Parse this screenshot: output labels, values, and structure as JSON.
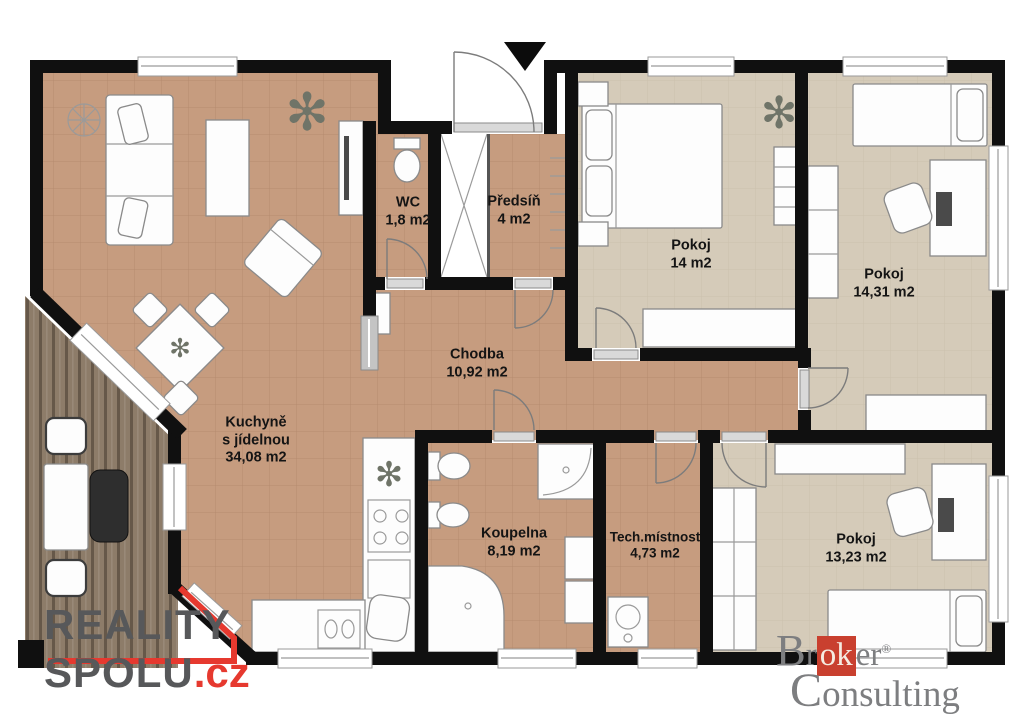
{
  "title": "Floor plan",
  "rooms": {
    "kuchyne": {
      "label": "Kuchyně",
      "label2": "s jídelnou",
      "area": "34,08 m2"
    },
    "wc": {
      "label": "WC",
      "area": "1,8 m2"
    },
    "predsin": {
      "label": "Předsíň",
      "area": "4 m2"
    },
    "chodba": {
      "label": "Chodba",
      "area": "10,92 m2"
    },
    "koupelna": {
      "label": "Koupelna",
      "area": "8,19 m2"
    },
    "tech": {
      "label": "Tech.místnost",
      "area": "4,73 m2"
    },
    "pokoj1": {
      "label": "Pokoj",
      "area": "14 m2"
    },
    "pokoj2": {
      "label": "Pokoj",
      "area": "14,31 m2"
    },
    "pokoj3": {
      "label": "Pokoj",
      "area": "13,23 m2"
    }
  },
  "icons": {
    "plant": "✻"
  },
  "logos": {
    "reality_spolu": {
      "word1": "REALITY",
      "word2": "SPOLU",
      "tld": ".cz"
    },
    "broker": {
      "prefix": "Br",
      "ok": "ok",
      "suffix": "er",
      "registered": "®",
      "word2": "Consulting"
    }
  },
  "colors": {
    "floor_warm": "#c69c7f",
    "floor_beige": "#d5cbb9",
    "wall": "#101010",
    "terrace_wood": "#8d7c69",
    "accent_red": "#e6392f",
    "logo_gray": "#57585a",
    "broker_gray": "#7d7e80",
    "broker_red": "#c9402f"
  }
}
